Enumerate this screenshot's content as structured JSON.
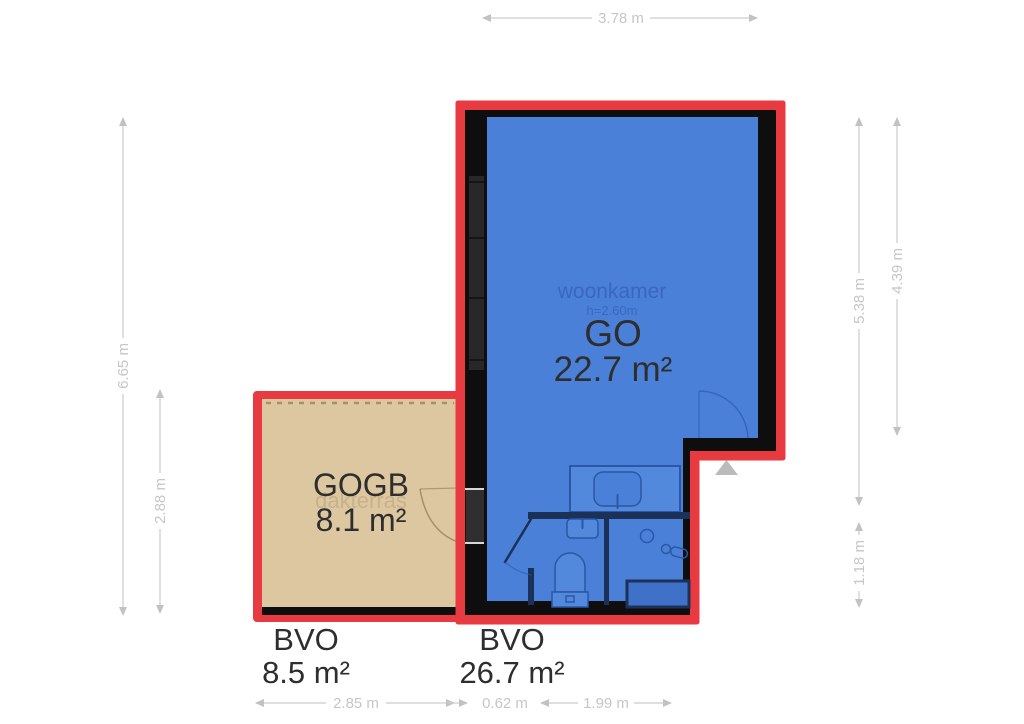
{
  "floorplan": {
    "rooms": {
      "woonkamer": {
        "name": "woonkamer",
        "ceiling_height": "h=2.60m",
        "usable_label": "GO",
        "usable_area": "22.7 m²",
        "gross_label": "BVO",
        "gross_area": "26.7 m²"
      },
      "dakterras": {
        "name": "dakterras",
        "usable_label": "GOGB",
        "usable_area": "8.1 m²",
        "gross_label": "BVO",
        "gross_area": "8.5 m²"
      }
    },
    "dimensions": {
      "top": "3.78 m",
      "left_outer": "6.65 m",
      "left_inner": "2.88 m",
      "right_outer": "5.38 m",
      "right_inner": "4.39 m",
      "right_lower": "1.18 m",
      "bottom_left": "2.85 m",
      "bottom_center": "0.62 m",
      "bottom_right": "1.99 m"
    },
    "icons": {
      "entrance_arrow": "triangle-up-icon"
    },
    "colors": {
      "outline_red": "#e73a41",
      "wall_black": "#0e0e0e",
      "room_blue": "#4b80d8",
      "room_tan": "#dcc7a1",
      "interior_wall_navy": "#1c3157",
      "fixture_stroke_blue": "#2a57a6",
      "dimension_gray": "#c9c9c9",
      "entrance_arrow_gray": "#bbbbbb"
    }
  }
}
